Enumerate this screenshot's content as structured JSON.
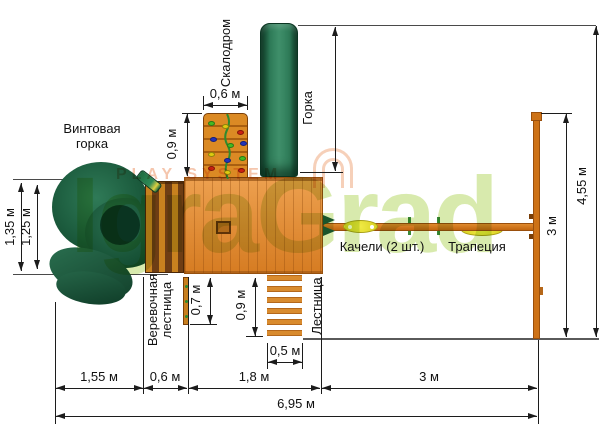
{
  "equipment": {
    "spiral_slide_line1": "Винтовая",
    "spiral_slide_line2": "горка",
    "climbing_wall": "Скалодром",
    "slide_label": "Горка",
    "slide_length": "2,3 м",
    "rope_ladder_line1": "Веревочная",
    "rope_ladder_line2": "лестница",
    "ladder": "Лестница",
    "swings": "Качели (2 шт.)",
    "trapeze": "Трапеция"
  },
  "dimensions": {
    "wall_width": "0,6 м",
    "wall_depth": "0,9 м",
    "spiral_outer": "1,35 м",
    "spiral_inner": "1,25 м",
    "rope_ladder_drop": "0,7 м",
    "ladder_run": "0,9 м",
    "ladder_width": "0,5 м",
    "segment_spiral": "1,55 м",
    "segment_rope": "0,6 м",
    "segment_platform": "1,8 м",
    "segment_swings": "3 м",
    "total_length": "6,95 м",
    "swing_frame_depth": "3 м",
    "total_depth": "4,55 м"
  },
  "watermarks": {
    "brand": "IgraGrad",
    "secondary": "PLAY SYSTEM"
  },
  "colors": {
    "wood": "#d97f26",
    "wood_dark": "#8a4a10",
    "slide_green": "#1e5c41",
    "dimension_ink": "#1c1c1c",
    "watermark_green": "#b8d96a",
    "watermark_salmon": "#ef9f76",
    "hold_red": "#cc2211",
    "hold_blue": "#2233bb",
    "hold_yellow": "#ddcc11",
    "hold_green": "#44bb22",
    "swing_seat_yellow": "#e8e23a"
  }
}
